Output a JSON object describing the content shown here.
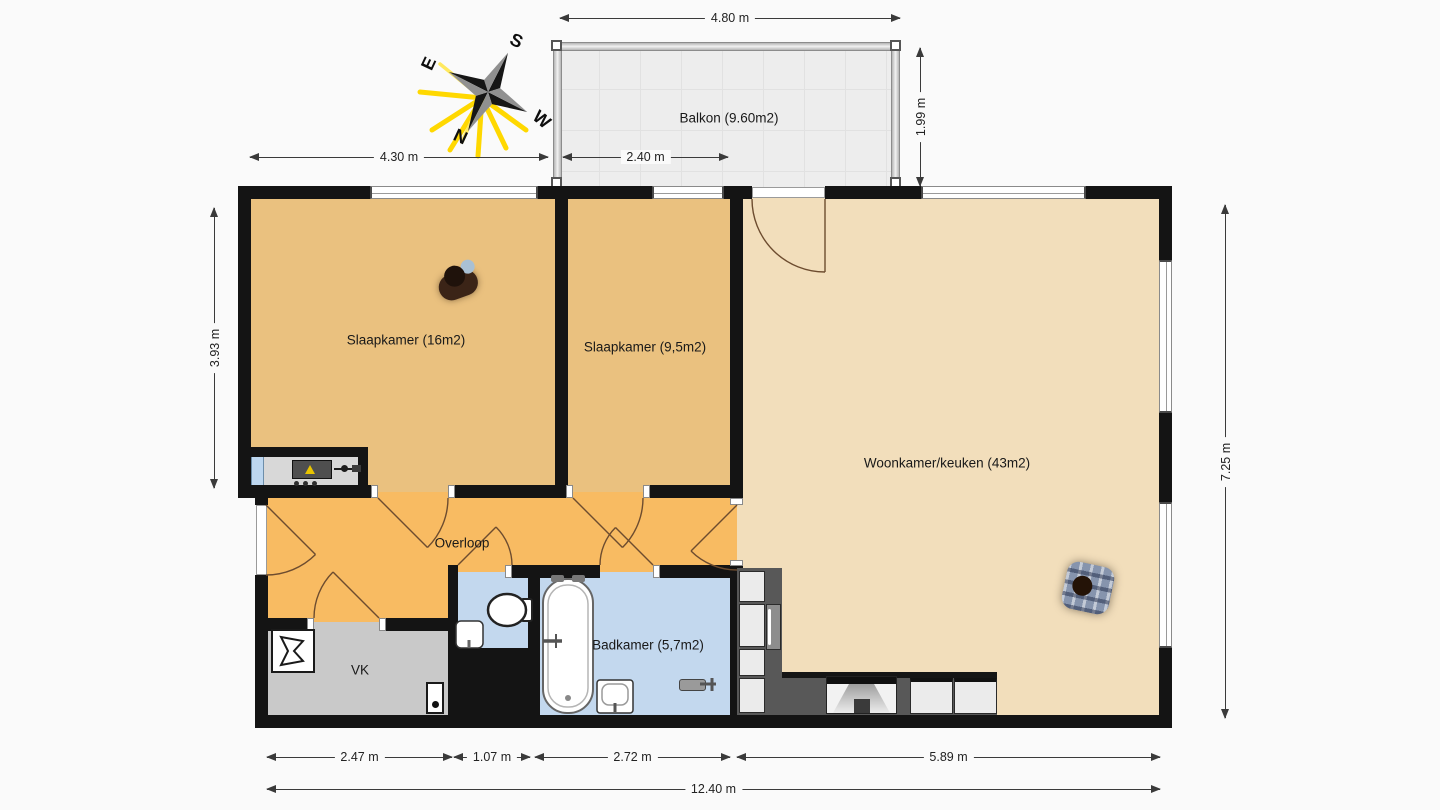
{
  "rooms": {
    "balkon": "Balkon (9.60m2)",
    "slaapkamer_1": "Slaapkamer (16m2)",
    "slaapkamer_2": "Slaapkamer (9,5m2)",
    "woonkamer": "Woonkamer/keuken (43m2)",
    "overloop": "Overloop",
    "badkamer": "Badkamer (5,7m2)",
    "vk": "VK"
  },
  "dimensions": {
    "balcony_width": "4.80 m",
    "balcony_depth": "1.99 m",
    "top_left": "4.30 m",
    "balcony_inner": "2.40 m",
    "left_height": "3.93 m",
    "right_height": "7.25 m",
    "bottom_seg1": "2.47 m",
    "bottom_seg2": "1.07 m",
    "bottom_seg3": "2.72 m",
    "bottom_seg4": "5.89 m",
    "bottom_total": "12.40 m"
  },
  "compass": {
    "north": "N",
    "east": "E",
    "south": "S",
    "west": "W"
  },
  "colors": {
    "bedroom_floor": "#eac17f",
    "living_floor": "#f2debb",
    "hall_floor": "#f8bb62",
    "bath_floor": "#c3d8ee",
    "vk_floor": "#c9c9c9",
    "balcony_floor": "#ededed",
    "wall": "#141414",
    "kitchen_counter": "#585858",
    "door_arc": "#6d4c2f",
    "compass_rays": "#ffd800"
  }
}
